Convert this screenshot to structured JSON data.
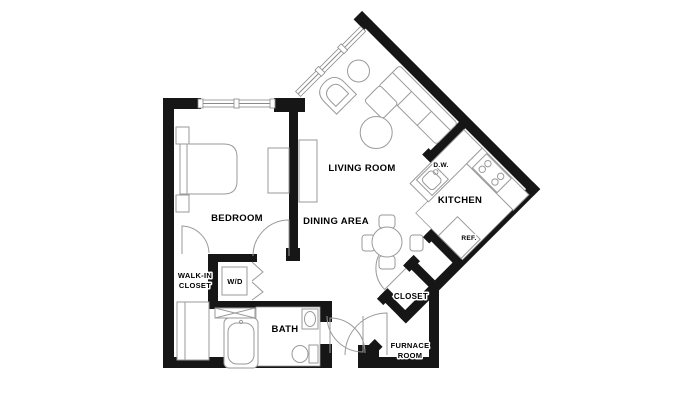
{
  "labels": {
    "living_room": "LIVING ROOM",
    "dining_area": "DINING AREA",
    "bedroom": "BEDROOM",
    "kitchen": "KITCHEN",
    "bath": "BATH",
    "closet": "CLOSET",
    "walk_in_closet_line1": "WALK-IN",
    "walk_in_closet_line2": "CLOSET",
    "furnace_room_line1": "FURNACE",
    "furnace_room_line2": "ROOM",
    "washer_dryer": "W/D",
    "dishwasher": "D.W.",
    "refrigerator": "REF."
  },
  "colors": {
    "background": "#ffffff",
    "wall": "#161616",
    "furniture_line": "#9a9a9a",
    "tile_line": "#c2c2c2",
    "label_text": "#000000"
  }
}
